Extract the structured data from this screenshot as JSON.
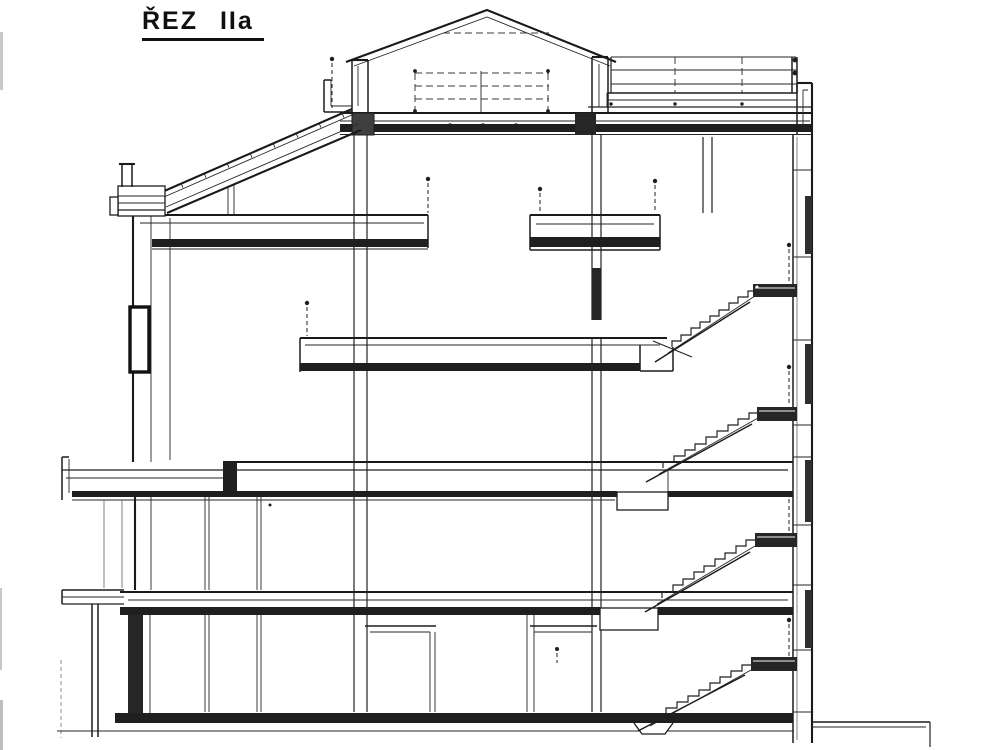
{
  "drawing": {
    "title": "ŘEZ IIa"
  },
  "colors": {
    "ink": "#1d1d1d",
    "paper": "#ffffff",
    "landing_fill": "#262626"
  }
}
